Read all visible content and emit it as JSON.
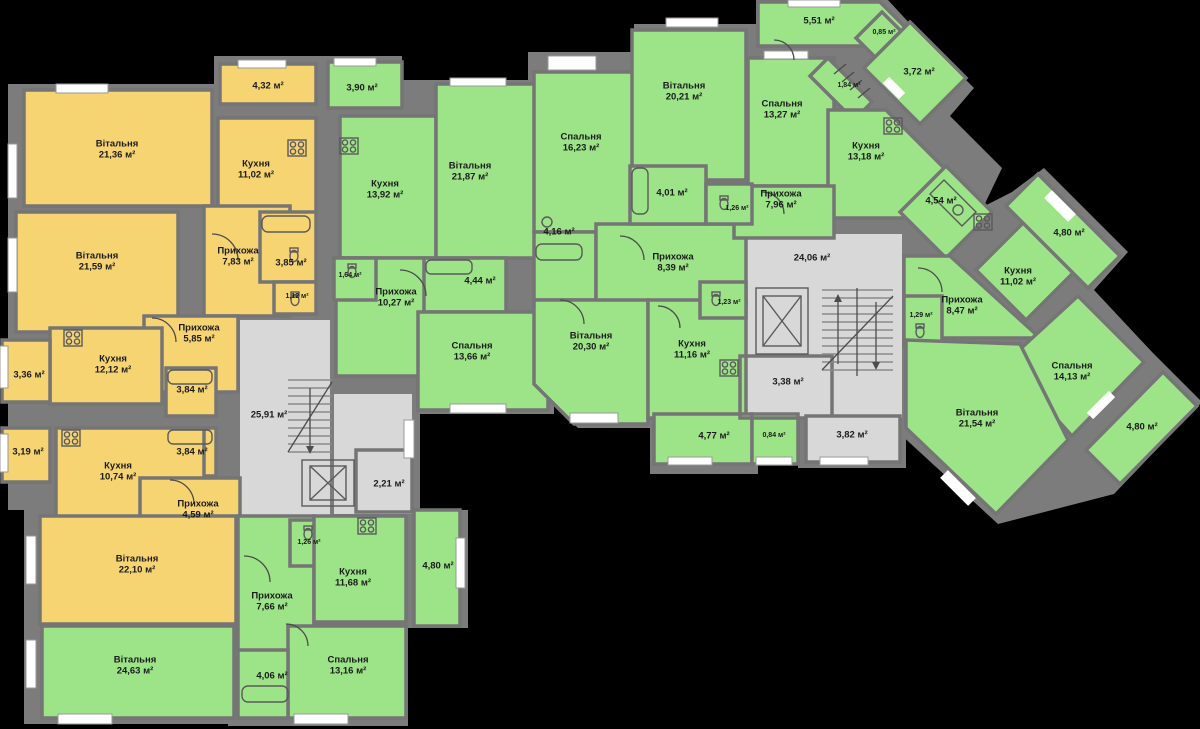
{
  "colors": {
    "background": "#000000",
    "wall": "#7c7c7c",
    "common_floor": "#d8d8d8",
    "apartment_yellow": "#f7d472",
    "apartment_green": "#9ce487",
    "window": "#ffffff",
    "label_text": "#1b1b1b"
  },
  "rooms": [
    {
      "name": "",
      "area": "4,32 м²"
    },
    {
      "name": "Вітальня",
      "area": "21,36 м²"
    },
    {
      "name": "Кухня",
      "area": "11,02 м²"
    },
    {
      "name": "Прихожа",
      "area": "7,83 м²"
    },
    {
      "name": "",
      "area": "3,85 м²"
    },
    {
      "name": "",
      "area": "1,12 м²"
    },
    {
      "name": "Вітальня",
      "area": "21,59 м²"
    },
    {
      "name": "Прихожа",
      "area": "5,85 м²"
    },
    {
      "name": "Кухня",
      "area": "12,12 м²"
    },
    {
      "name": "",
      "area": "3,36 м²"
    },
    {
      "name": "",
      "area": "3,84 м²"
    },
    {
      "name": "",
      "area": "3,84 м²"
    },
    {
      "name": "",
      "area": "3,19 м²"
    },
    {
      "name": "Кухня",
      "area": "10,74 м²"
    },
    {
      "name": "Прихожа",
      "area": "4,59 м²"
    },
    {
      "name": "Вітальня",
      "area": "22,10 м²"
    },
    {
      "name": "Вітальня",
      "area": "24,63 м²"
    },
    {
      "name": "Прихожа",
      "area": "7,66 м²"
    },
    {
      "name": "",
      "area": "1,26 м²"
    },
    {
      "name": "Кухня",
      "area": "11,68 м²"
    },
    {
      "name": "",
      "area": "4,80 м²"
    },
    {
      "name": "Спальня",
      "area": "13,16 м²"
    },
    {
      "name": "",
      "area": "4,06 м²"
    },
    {
      "name": "",
      "area": "25,91 м²"
    },
    {
      "name": "",
      "area": "2,21 м²"
    },
    {
      "name": "",
      "area": "3,90 м²"
    },
    {
      "name": "Кухня",
      "area": "13,92 м²"
    },
    {
      "name": "Вітальня",
      "area": "21,87 м²"
    },
    {
      "name": "",
      "area": "1,64 м²"
    },
    {
      "name": "Прихожа",
      "area": "10,27 м²"
    },
    {
      "name": "",
      "area": "4,44 м²"
    },
    {
      "name": "Спальня",
      "area": "13,66 м²"
    },
    {
      "name": "Спальня",
      "area": "16,23 м²"
    },
    {
      "name": "",
      "area": "4,16 м²"
    },
    {
      "name": "Прихожа",
      "area": "8,39 м²"
    },
    {
      "name": "Вітальня",
      "area": "20,30 м²"
    },
    {
      "name": "Кухня",
      "area": "11,16 м²"
    },
    {
      "name": "",
      "area": "1,23 м²"
    },
    {
      "name": "",
      "area": "4,77 м²"
    },
    {
      "name": "",
      "area": "0,84 м²"
    },
    {
      "name": "Вітальня",
      "area": "20,21 м²"
    },
    {
      "name": "Спальня",
      "area": "13,27 м²"
    },
    {
      "name": "",
      "area": "5,51 м²"
    },
    {
      "name": "",
      "area": "1,84 м²"
    },
    {
      "name": "",
      "area": "0,85 м²"
    },
    {
      "name": "",
      "area": "3,72 м²"
    },
    {
      "name": "Кухня",
      "area": "13,18 м²"
    },
    {
      "name": "Прихожа",
      "area": "7,96 м²"
    },
    {
      "name": "",
      "area": "4,01 м²"
    },
    {
      "name": "",
      "area": "1,26 м²"
    },
    {
      "name": "",
      "area": "4,54 м²"
    },
    {
      "name": "",
      "area": "24,06 м²"
    },
    {
      "name": "",
      "area": "3,38 м²"
    },
    {
      "name": "",
      "area": "3,82 м²"
    },
    {
      "name": "",
      "area": "1,29 м²"
    },
    {
      "name": "Кухня",
      "area": "11,02 м²"
    },
    {
      "name": "Прихожа",
      "area": "8,47 м²"
    },
    {
      "name": "",
      "area": "4,80 м²"
    },
    {
      "name": "Спальня",
      "area": "14,13 м²"
    },
    {
      "name": "Вітальня",
      "area": "21,54 м²"
    },
    {
      "name": "",
      "area": "4,80 м²"
    }
  ]
}
